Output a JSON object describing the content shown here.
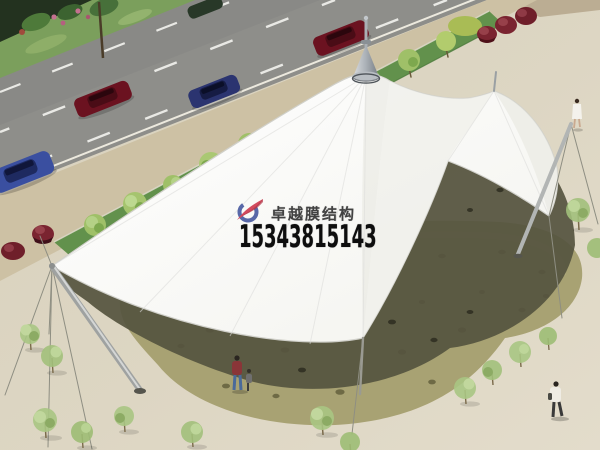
{
  "image": {
    "type": "architectural-rendering",
    "subject": "Aerial rendering of a white multi-peak tensile membrane canopy over a stone-paved plaza beside a road"
  },
  "watermark": {
    "company_name": "卓越膜结构",
    "phone_number": "15343815143",
    "logo_icon": "red-blue-swoosh-logo",
    "company_color": "#414141",
    "phone_color": "#0e0e0e"
  },
  "scene": {
    "colors": {
      "membrane_white": "#fbfbf7",
      "plaza_sand": "#ddd6c3",
      "road_gray": "#8e8e8a",
      "verge_grass": "#7b9f5c",
      "median_green": "#62914c",
      "stone_olive": "#a8a273",
      "canopy_shadow": "#55543f",
      "car_dark_red": "#6b1220",
      "car_blue": "#3a4fa0",
      "red_bush": "#7a2430",
      "mast_steel": "#aeb1b0"
    },
    "elements": [
      "road with dashed lane lines",
      "cars (dark red, navy, blue)",
      "green median with row of small trees",
      "dark red shrubs",
      "white tensile canopy with conical peak and side lobes",
      "steel masts, props and guy cables",
      "organic stone-paved area with cast shadow",
      "scattered sapling trees",
      "three pedestrians"
    ]
  }
}
